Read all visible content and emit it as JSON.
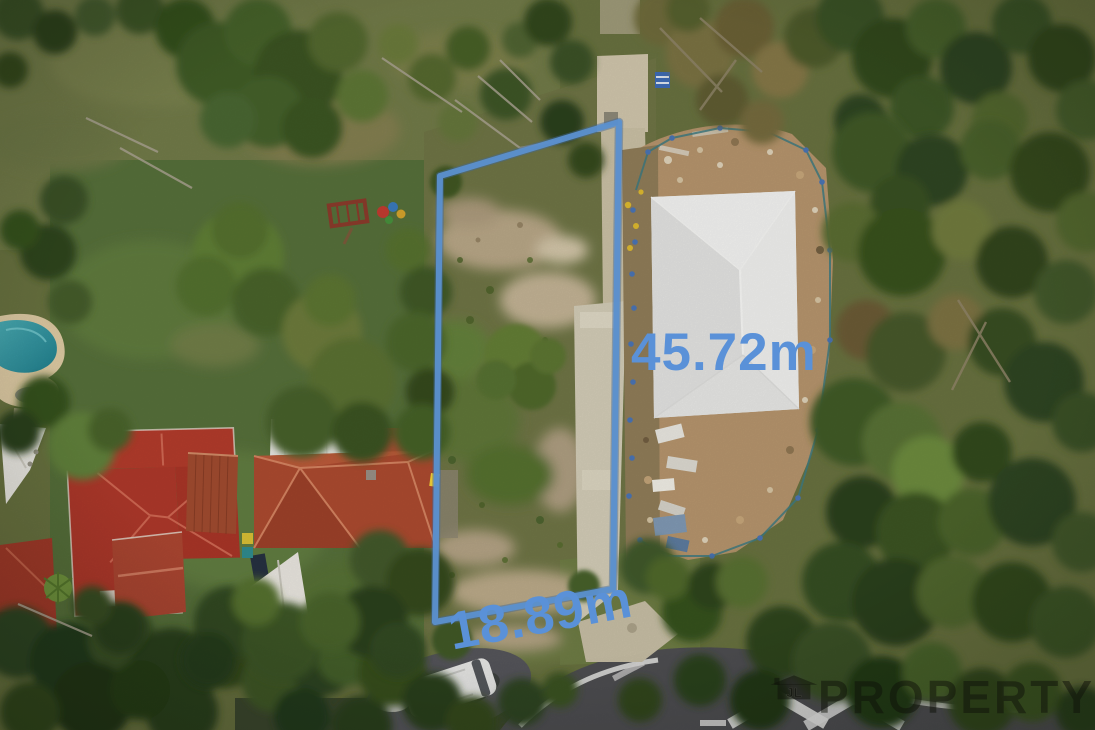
{
  "meta": {
    "kind": "aerial drone photograph of a vacant residential lot with property-dimension overlay",
    "width_px": 1095,
    "height_px": 730
  },
  "boundary_overlay": {
    "points": "440,176 619,122 613,589 435,622",
    "line_color": "#5b90cf",
    "label_color": "#5a91d8",
    "labels": {
      "side": "45.72m",
      "frontage": "18.89m"
    }
  },
  "watermark": {
    "monogram": "JL",
    "wordmark": "PROPERTY"
  }
}
